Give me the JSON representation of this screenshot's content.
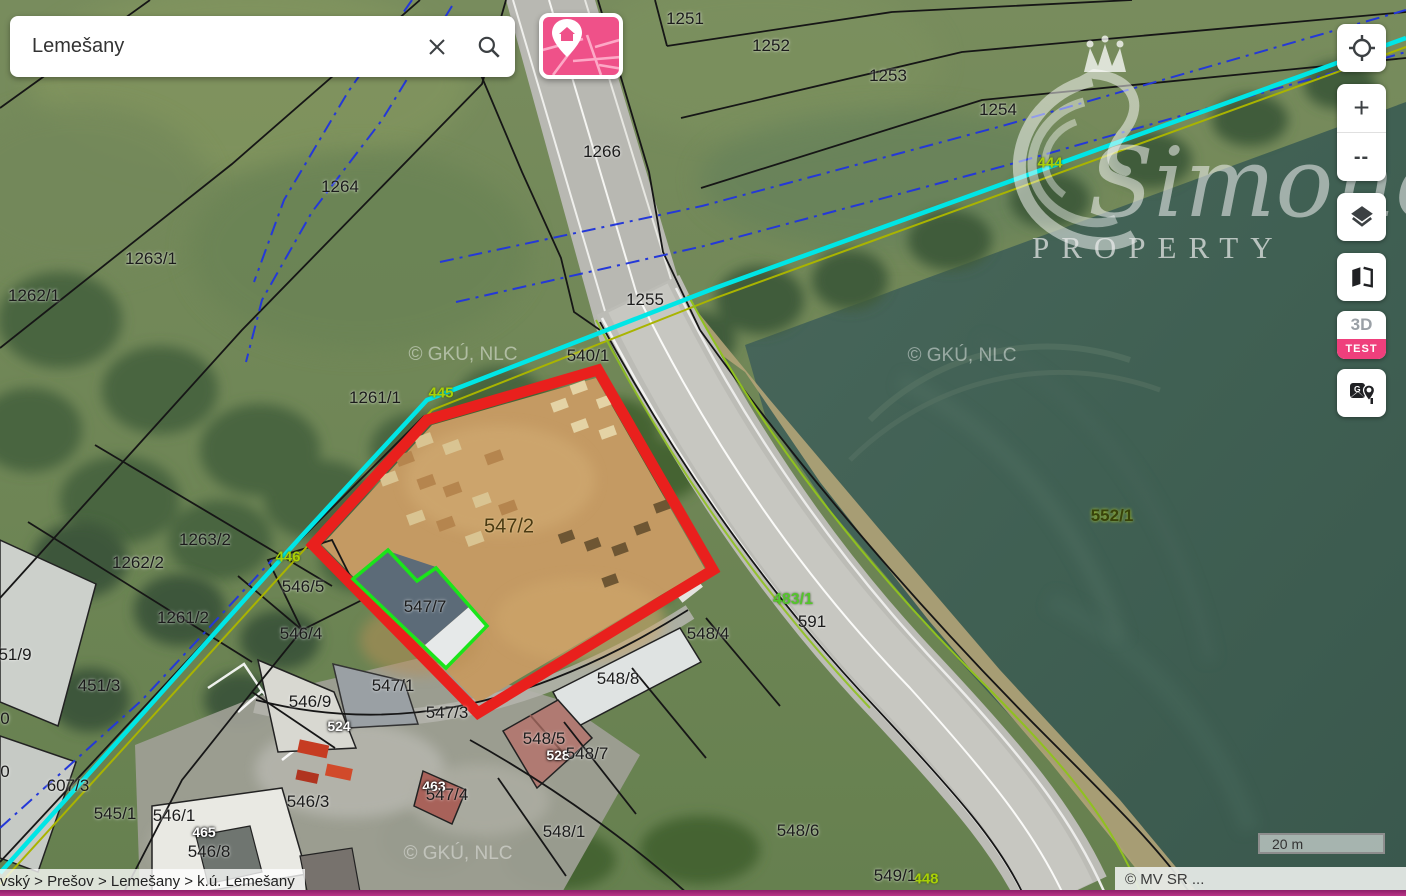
{
  "search": {
    "value": "Lemešany"
  },
  "map_style_button": {
    "icon": "map-with-pin-icon"
  },
  "controls": {
    "zoom_in_label": "+",
    "zoom_out_label": "--",
    "three_d_label": "3D",
    "test_badge": "TEST",
    "icons": [
      "locate-icon",
      "layers-icon",
      "compare-maps-icon",
      "google-maps-pin-icon"
    ]
  },
  "breadcrumb": {
    "text": "vský > Prešov > Lemešany > k.ú. Lemešany"
  },
  "scale_bar": {
    "label": "20 m"
  },
  "attribution": {
    "text": "© MV SR ..."
  },
  "watermarks": {
    "tile_text": "© GKÚ, NLC",
    "brand_name": "Simone",
    "brand_sub": "PROPERTY",
    "brand_icon": "swan-crown-logo"
  },
  "colors": {
    "brand_pink": "#ef5189",
    "selection_red": "#e9201d",
    "highlight_green": "#1ae51a",
    "stream_cyan": "#00e6e6",
    "bottom_bar_magenta": "#a62b7c"
  },
  "map_labels": [
    {
      "text": "1251",
      "x": 685,
      "y": 19,
      "type": "parcel"
    },
    {
      "text": "1252",
      "x": 771,
      "y": 46,
      "type": "parcel"
    },
    {
      "text": "1253",
      "x": 888,
      "y": 76,
      "type": "parcel"
    },
    {
      "text": "1254",
      "x": 998,
      "y": 110,
      "type": "parcel"
    },
    {
      "text": "1266",
      "x": 602,
      "y": 152,
      "type": "parcel"
    },
    {
      "text": "1264",
      "x": 340,
      "y": 187,
      "type": "parcel"
    },
    {
      "text": "1263/1",
      "x": 151,
      "y": 259,
      "type": "parcel"
    },
    {
      "text": "1262/1",
      "x": 34,
      "y": 296,
      "type": "parcel"
    },
    {
      "text": "1255",
      "x": 645,
      "y": 300,
      "type": "parcel"
    },
    {
      "text": "540/1",
      "x": 588,
      "y": 356,
      "type": "parcel"
    },
    {
      "text": "1261/1",
      "x": 375,
      "y": 398,
      "type": "parcel"
    },
    {
      "text": "445",
      "x": 441,
      "y": 393,
      "type": "stream"
    },
    {
      "text": "444",
      "x": 1050,
      "y": 163,
      "type": "stream"
    },
    {
      "text": "446",
      "x": 288,
      "y": 557,
      "type": "stream"
    },
    {
      "text": "448",
      "x": 926,
      "y": 879,
      "type": "stream"
    },
    {
      "text": "1263/2",
      "x": 205,
      "y": 540,
      "type": "parcel"
    },
    {
      "text": "1262/2",
      "x": 138,
      "y": 563,
      "type": "parcel"
    },
    {
      "text": "1261/2",
      "x": 183,
      "y": 618,
      "type": "parcel"
    },
    {
      "text": "546/5",
      "x": 303,
      "y": 587,
      "type": "parcel"
    },
    {
      "text": "547/2",
      "x": 509,
      "y": 527,
      "type": "brown"
    },
    {
      "text": "547/7",
      "x": 425,
      "y": 607,
      "type": "parcel"
    },
    {
      "text": "546/4",
      "x": 301,
      "y": 634,
      "type": "parcel"
    },
    {
      "text": "548/4",
      "x": 708,
      "y": 634,
      "type": "parcel"
    },
    {
      "text": "547/1",
      "x": 393,
      "y": 686,
      "type": "parcel"
    },
    {
      "text": "546/9",
      "x": 310,
      "y": 702,
      "type": "parcel"
    },
    {
      "text": "547/3",
      "x": 447,
      "y": 713,
      "type": "parcel"
    },
    {
      "text": "548/8",
      "x": 618,
      "y": 679,
      "type": "parcel"
    },
    {
      "text": "483/1",
      "x": 793,
      "y": 600,
      "type": "green"
    },
    {
      "text": "591",
      "x": 812,
      "y": 622,
      "type": "parcel"
    },
    {
      "text": "552/1",
      "x": 1112,
      "y": 516,
      "type": "olive"
    },
    {
      "text": "524",
      "x": 339,
      "y": 726,
      "type": "white"
    },
    {
      "text": "548/5",
      "x": 544,
      "y": 739,
      "type": "parcel"
    },
    {
      "text": "528",
      "x": 558,
      "y": 755,
      "type": "white"
    },
    {
      "text": "548/7",
      "x": 587,
      "y": 754,
      "type": "parcel"
    },
    {
      "text": "463",
      "x": 434,
      "y": 786,
      "type": "white"
    },
    {
      "text": "547/4",
      "x": 447,
      "y": 795,
      "type": "parcel"
    },
    {
      "text": "546/3",
      "x": 308,
      "y": 802,
      "type": "parcel"
    },
    {
      "text": "451/3",
      "x": 99,
      "y": 686,
      "type": "parcel"
    },
    {
      "text": "51/9",
      "x": 15,
      "y": 655,
      "type": "parcel"
    },
    {
      "text": "607/3",
      "x": 68,
      "y": 786,
      "type": "parcel"
    },
    {
      "text": "545/1",
      "x": 115,
      "y": 814,
      "type": "parcel"
    },
    {
      "text": "546/1",
      "x": 174,
      "y": 816,
      "type": "parcel"
    },
    {
      "text": "465",
      "x": 204,
      "y": 832,
      "type": "white"
    },
    {
      "text": "546/8",
      "x": 209,
      "y": 852,
      "type": "parcel"
    },
    {
      "text": "548/1",
      "x": 564,
      "y": 832,
      "type": "parcel"
    },
    {
      "text": "548/6",
      "x": 798,
      "y": 831,
      "type": "parcel"
    },
    {
      "text": "549/1",
      "x": 895,
      "y": 876,
      "type": "parcel"
    },
    {
      "text": "0",
      "x": 5,
      "y": 719,
      "type": "parcel"
    },
    {
      "text": "0",
      "x": 5,
      "y": 772,
      "type": "parcel"
    }
  ]
}
